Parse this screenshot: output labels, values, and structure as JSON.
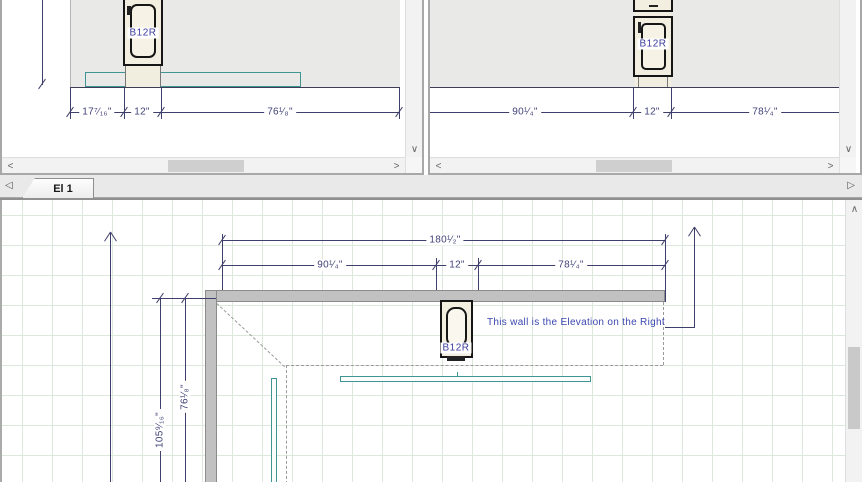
{
  "tabs": {
    "active": "El 1"
  },
  "icons": {
    "tab_prev": "◁",
    "tab_next": "▷",
    "scroll_up": "∧",
    "scroll_down": "∨",
    "scroll_left": "<",
    "scroll_right": ">"
  },
  "left_elevation": {
    "cabinet_label": "B12R",
    "dims": [
      "17⁷⁄₁₆\"",
      "12\"",
      "76¹⁄₈\""
    ]
  },
  "right_elevation": {
    "cabinet_label": "B12R",
    "dims": [
      "90¹⁄₄\"",
      "12\"",
      "78¹⁄₄\""
    ]
  },
  "plan": {
    "cabinet_label": "B12R",
    "annotation": "This wall is the Elevation on the Right",
    "dim_total": "180¹⁄₂\"",
    "dims_top": [
      "90¹⁄₄\"",
      "12\"",
      "78¹⁄₄\""
    ],
    "dims_left": [
      "105⁹⁄₁₆\"",
      "76¹⁄₈\""
    ]
  },
  "colors": {
    "dimension_line": "#3f3f6b",
    "annotation_text": "#3b47b0",
    "countertop_teal": "#3f9494",
    "wall_fill_plan": "#c1c1c1",
    "wall_fill_elevation": "#e9e9e8",
    "grid_green": "#dbe8db"
  }
}
